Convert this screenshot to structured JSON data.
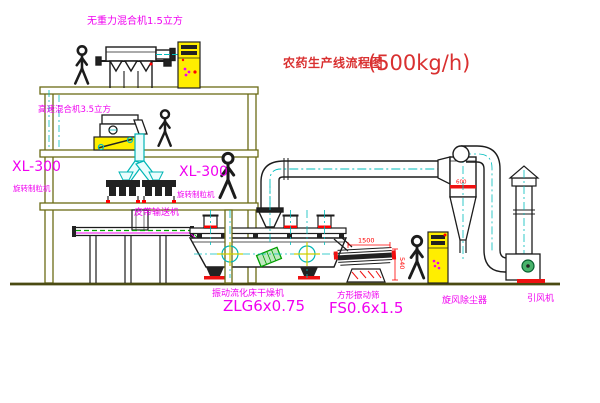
{
  "title": {
    "text": "农药生产线流程图",
    "capacity": "(500kg/h)"
  },
  "labels": {
    "gravity_free_mixer": "无重力混合机1.5立方",
    "high_speed_mixer": "高速混合机3.5立方",
    "granulator_left_model": "XL-300",
    "granulator_left_name": "旋转制粒机",
    "granulator_right_model": "XL-300",
    "granulator_right_name": "旋转制粒机",
    "belt_conveyor": "皮带输送机",
    "dryer_name": "振动流化床干燥机",
    "dryer_model": "ZLG6x0.75",
    "sieve_name": "方形振动筛",
    "sieve_model": "FS0.6x1.5",
    "cyclone": "旋风除尘器",
    "fan": "引风机"
  },
  "dimensions": {
    "sieve_length": "1500",
    "sieve_height": "540",
    "cyclone_diameter": "600"
  },
  "colors": {
    "label_magenta": "#f000f0",
    "title_red": "#d93030",
    "dimension_red": "#ff0000",
    "centerline_cyan": "#00bdbd",
    "structure_olive": "#6b6b15",
    "cabinet_yellow": "#ffee00",
    "motor_green": "#00a000"
  }
}
